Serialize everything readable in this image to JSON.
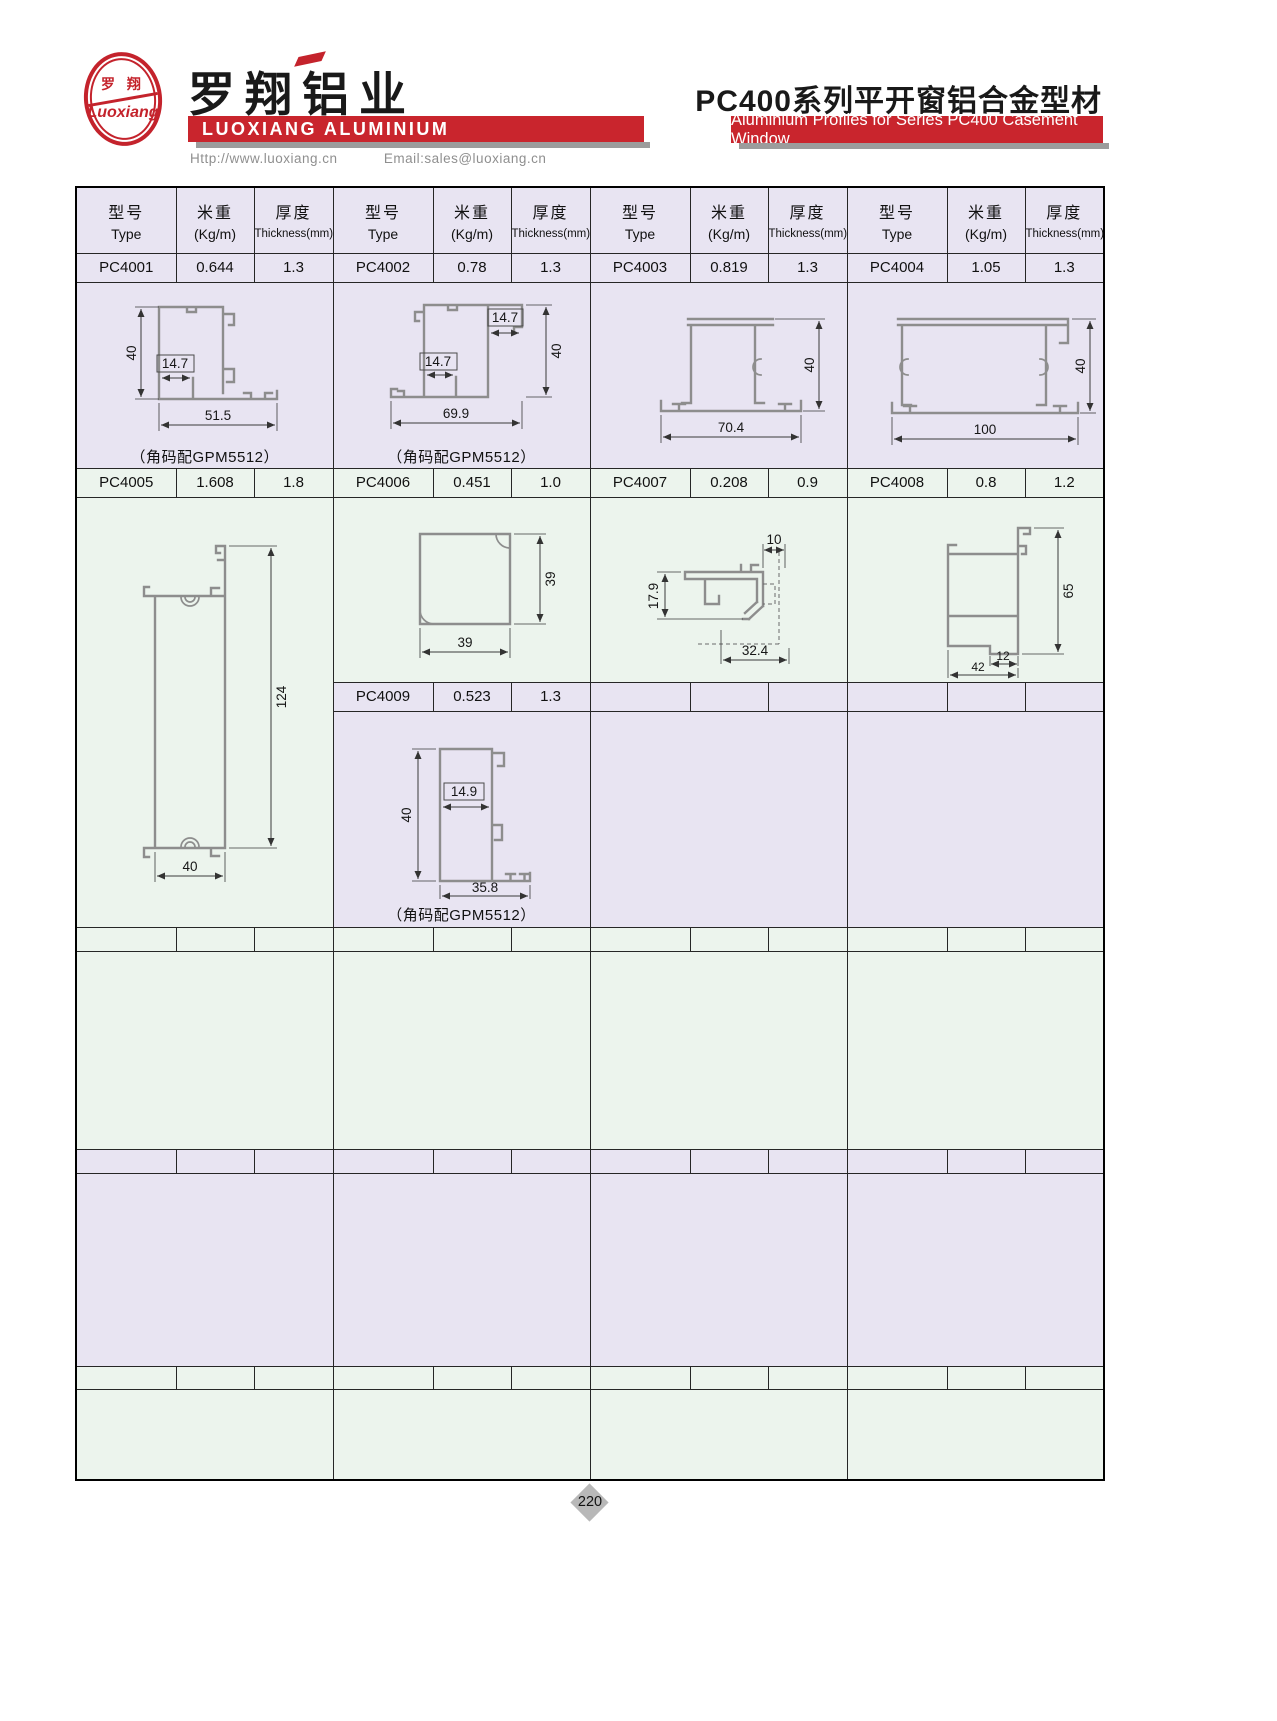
{
  "brand": {
    "logo_cn": "罗 翔",
    "logo_script": "Luoxiang",
    "company_cn": "罗翔铝业",
    "company_en": "LUOXIANG ALUMINIUM",
    "website": "Http://www.luoxiang.cn",
    "email": "Email:sales@luoxiang.cn"
  },
  "header": {
    "title_cn": "PC400系列平开窗铝合金型材",
    "subtitle_en": "Aluminium Profiles for Series PC400 Casement Window"
  },
  "table": {
    "col_headers": {
      "type_cn": "型号",
      "type_en": "Type",
      "weight_cn": "米重",
      "weight_en": "(Kg/m)",
      "thickness_cn": "厚度",
      "thickness_en": "Thickness(mm)"
    },
    "profiles": {
      "pc4001": {
        "type": "PC4001",
        "weight": "0.644",
        "thickness": "1.3",
        "dim_h": "40",
        "dim_inner": "14.7",
        "dim_w": "51.5",
        "caption": "（角码配GPM5512）"
      },
      "pc4002": {
        "type": "PC4002",
        "weight": "0.78",
        "thickness": "1.3",
        "dim_top": "14.7",
        "dim_inner": "14.7",
        "dim_w": "69.9",
        "dim_h": "40",
        "caption": "（角码配GPM5512）"
      },
      "pc4003": {
        "type": "PC4003",
        "weight": "0.819",
        "thickness": "1.3",
        "dim_h": "40",
        "dim_w": "70.4"
      },
      "pc4004": {
        "type": "PC4004",
        "weight": "1.05",
        "thickness": "1.3",
        "dim_h": "40",
        "dim_w": "100"
      },
      "pc4005": {
        "type": "PC4005",
        "weight": "1.608",
        "thickness": "1.8",
        "dim_h": "124",
        "dim_w": "40"
      },
      "pc4006": {
        "type": "PC4006",
        "weight": "0.451",
        "thickness": "1.0",
        "dim_h": "39",
        "dim_w": "39"
      },
      "pc4007": {
        "type": "PC4007",
        "weight": "0.208",
        "thickness": "0.9",
        "dim_h": "17.9",
        "dim_top": "10",
        "dim_w": "32.4"
      },
      "pc4008": {
        "type": "PC4008",
        "weight": "0.8",
        "thickness": "1.2",
        "dim_h": "65",
        "dim_small": "12",
        "dim_w": "42"
      },
      "pc4009": {
        "type": "PC4009",
        "weight": "0.523",
        "thickness": "1.3",
        "dim_h": "40",
        "dim_inner": "14.9",
        "dim_w": "35.8",
        "caption": "（角码配GPM5512）"
      }
    }
  },
  "footer": {
    "page_number": "220"
  },
  "colors": {
    "accent_red": "#c9252d",
    "band_lavender": "#e8e4f2",
    "band_green": "#ecf4ed",
    "shadow_gray": "#9c9c9c"
  }
}
